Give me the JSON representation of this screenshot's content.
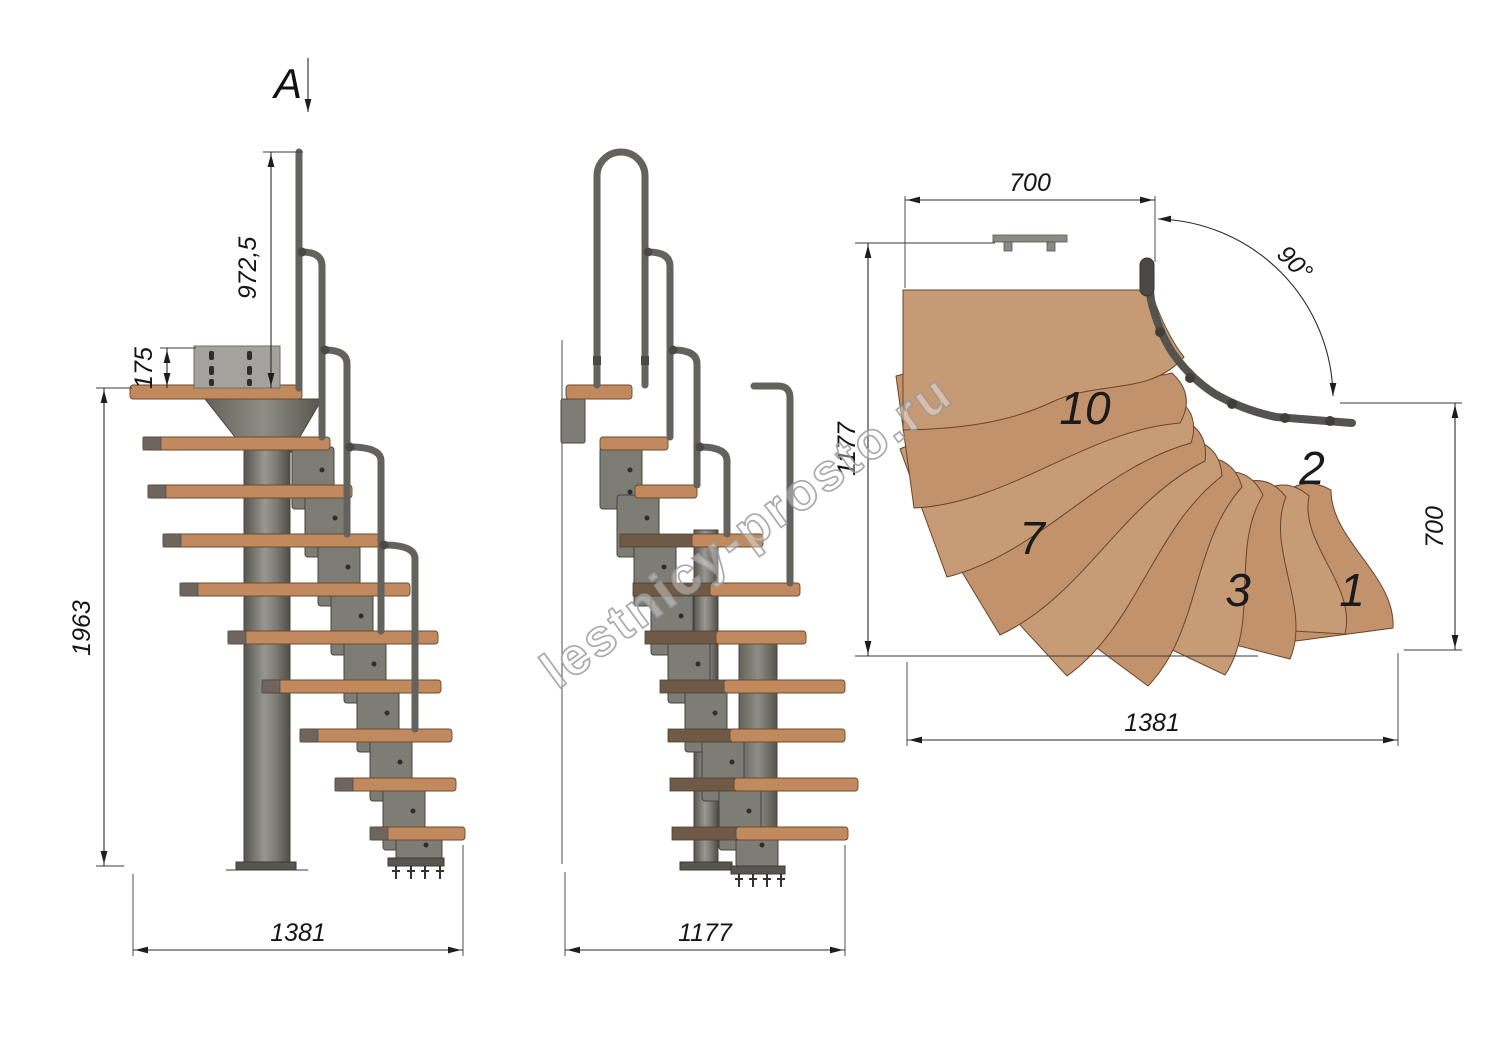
{
  "section": {
    "label": "A"
  },
  "watermark": {
    "text": "lestnicy-prosto.ru"
  },
  "side_view": {
    "handrail_height": "972,5",
    "plate_height": "175",
    "total_height": "1963",
    "total_length": "1381"
  },
  "front_view": {
    "total_width": "1177"
  },
  "plan_view": {
    "top_width": "700",
    "turn_angle": "90°",
    "left_depth": "1177",
    "right_width": "700",
    "bottom_length": "1381",
    "steps": {
      "s10": "10",
      "s7": "7",
      "s3": "3",
      "s2": "2",
      "s1": "1"
    }
  },
  "colors": {
    "wood_side": "#c08a5e",
    "wood_plan": "#c79a76",
    "metal": "#6b6a64",
    "dimension": "#2a2a2a"
  }
}
